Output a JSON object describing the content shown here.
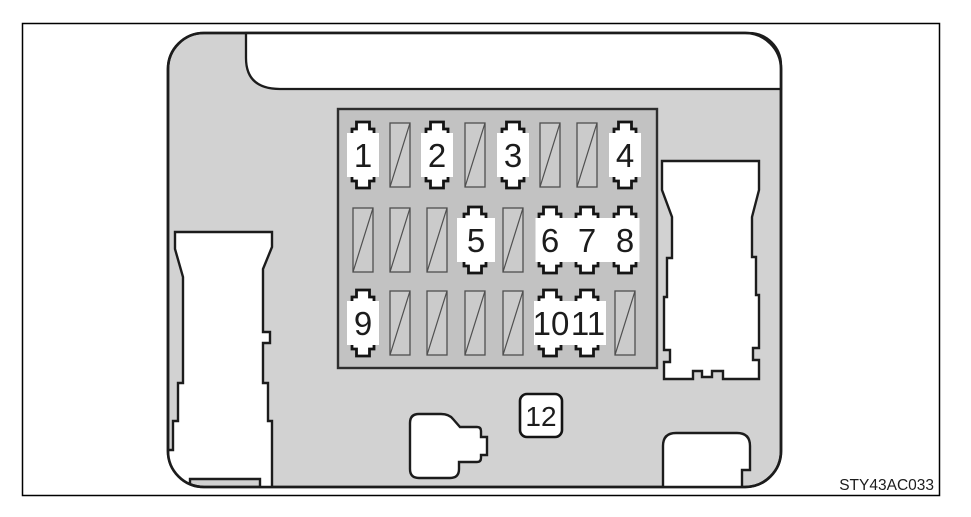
{
  "diagram": {
    "figure_code": "STY43AC033",
    "relay_box_label": "12",
    "colors": {
      "housing_gray": "#d2d2d2",
      "grid_gray": "#c2c2c2",
      "fuse_slot_gray": "#cbcbcb",
      "line_black": "#1c1c1c"
    },
    "fuse_grid": {
      "rows": [
        {
          "slots": [
            {
              "type": "fuse",
              "label": "1"
            },
            {
              "type": "unlabeled"
            },
            {
              "type": "fuse",
              "label": "2"
            },
            {
              "type": "unlabeled"
            },
            {
              "type": "fuse",
              "label": "3"
            },
            {
              "type": "unlabeled"
            },
            {
              "type": "unlabeled"
            },
            {
              "type": "fuse",
              "label": "4"
            }
          ]
        },
        {
          "slots": [
            {
              "type": "unlabeled"
            },
            {
              "type": "unlabeled"
            },
            {
              "type": "unlabeled"
            },
            {
              "type": "fuse",
              "label": "5"
            },
            {
              "type": "unlabeled"
            },
            {
              "type": "fuse",
              "label": "6"
            },
            {
              "type": "fuse",
              "label": "7"
            },
            {
              "type": "fuse",
              "label": "8"
            }
          ]
        },
        {
          "slots": [
            {
              "type": "fuse",
              "label": "9"
            },
            {
              "type": "unlabeled"
            },
            {
              "type": "unlabeled"
            },
            {
              "type": "unlabeled"
            },
            {
              "type": "unlabeled"
            },
            {
              "type": "fuse",
              "label": "10"
            },
            {
              "type": "fuse",
              "label": "11"
            },
            {
              "type": "unlabeled"
            }
          ]
        }
      ]
    }
  }
}
